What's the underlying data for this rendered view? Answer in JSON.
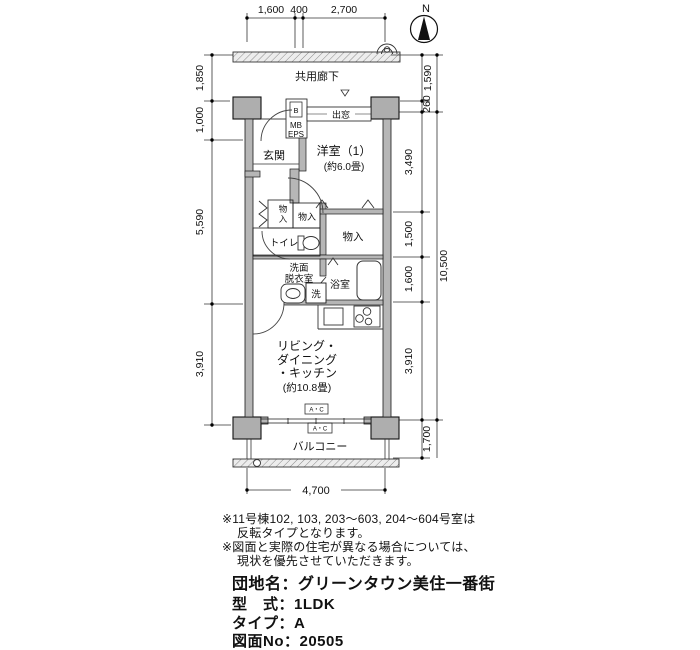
{
  "compass": {
    "north": "N"
  },
  "plan": {
    "corridor": "共用廊下",
    "bay_window": "出窓",
    "meter_b": "B",
    "meter_mb": "MB",
    "meter_eps": "EPS",
    "entrance": "玄関",
    "western_room": "洋室（1）",
    "western_room_size": "(約6.0畳)",
    "storage_v_char1": "物",
    "storage_v_char2": "入",
    "storage_small": "物入",
    "toilet": "トイレ",
    "storage_large": "物入",
    "washroom_line1": "洗面",
    "washroom_line2": "脱衣室",
    "washer": "洗",
    "bathroom": "浴室",
    "ldk_line1": "リビング・",
    "ldk_line2": "ダイニング",
    "ldk_line3": "・キッチン",
    "ldk_line4": "(約10.8畳)",
    "ac_unit1": "A・C",
    "ac_unit2": "A・C",
    "balcony": "バルコニー"
  },
  "dims": {
    "top": [
      "1,600",
      "400",
      "2,700"
    ],
    "left": [
      "1,850",
      "1,000",
      "5,590",
      "3,910"
    ],
    "right": [
      "1,590",
      "260",
      "3,490",
      "1,500",
      "1,600",
      "3,910",
      "1,700"
    ],
    "total": "10,500",
    "bottom": "4,700"
  },
  "notes": [
    "※11号棟102, 103, 203～603, 204～604号室は",
    "反転タイプとなります。",
    "※図面と実際の住宅が異なる場合については、",
    "現状を優先させていただきます。"
  ],
  "info": {
    "estate": "団地名：グリーンタウン美住一番街",
    "model": "型　式：1LDK",
    "type": "タイプ：A",
    "drawing_no": "図面No：20505"
  }
}
